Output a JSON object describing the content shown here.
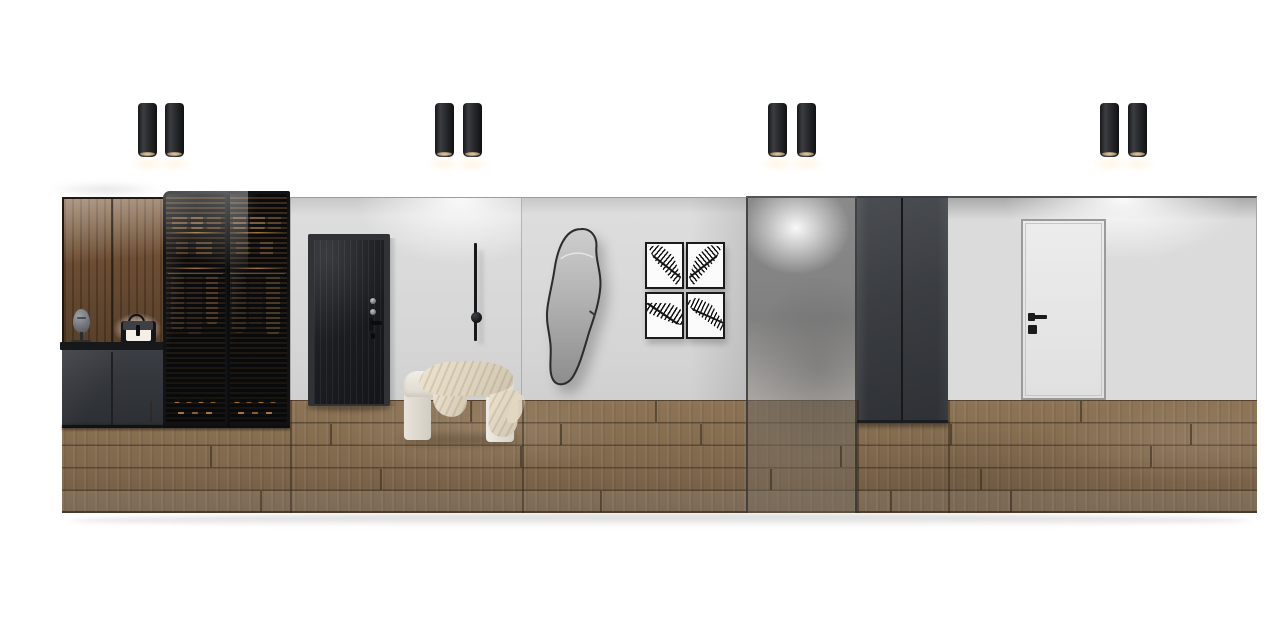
{
  "scene": {
    "title": "hallway-entry-interior-elevation-render",
    "background": "#ffffff",
    "objects": [
      "black cylinder ceiling spotlights (4 pairs)",
      "walnut display niche with mask sculpture and lit handbag shelf",
      "dark grey shoe cabinet with countertop",
      "slatted smoked-glass wardrobe with folded clothes, hanging garments and shoe rows",
      "black ribbed entry door with metal hardware",
      "thin black linear wall sconce with sphere",
      "cream upholstered waterfall bench with draped throw blanket",
      "organic-shaped wall mirror with thin black frame",
      "gallery of four black-framed palm leaf prints",
      "smoked glass partition panel",
      "charcoal double wall panels",
      "white flush interior door with black handle",
      "oak plank flooring strip with soft shadow below"
    ]
  },
  "palette": {
    "wall_light": "#dcdcdc",
    "wood_panel": "#6e4f36",
    "cabinet_dark": "#34373c",
    "wardrobe_black": "#17181b",
    "interior_warm": "#3a2b1e",
    "glow_warm": "#d89a52",
    "entry_door": "#1b1d20",
    "floor_wood": "#81694d",
    "bench_cream": "#e9e5dd",
    "blanket_cream": "#dcd2bd",
    "mirror_glass": "#a6a6a6",
    "glass_tint": "#8a8a8a",
    "panel_charcoal": "#3a3d41",
    "white_door": "#e4e4e4",
    "hardware_black": "#1b1b1b",
    "ceiling_line": "#4e4f52"
  },
  "lights": {
    "style": "black-cylinder-spot",
    "y": 103,
    "width": 19,
    "height": 54,
    "pairs": [
      [
        138,
        165
      ],
      [
        435,
        463
      ],
      [
        768,
        797
      ],
      [
        1100,
        1128
      ]
    ]
  },
  "gallery": {
    "theme": "palm-leaf-prints",
    "count": 4,
    "w": 39,
    "h": 47,
    "frames": [
      {
        "x": 645,
        "y": 242,
        "v": 1
      },
      {
        "x": 686,
        "y": 242,
        "v": 2
      },
      {
        "x": 645,
        "y": 292,
        "v": 3
      },
      {
        "x": 686,
        "y": 292,
        "v": 4
      }
    ]
  },
  "wardrobe": {
    "shelf_colors": [
      "#7b5a39",
      "#8a6843",
      "#684b2f"
    ],
    "accessory_colors": [
      "#5d4227",
      "#6e4e2e"
    ],
    "shoe_colors": [
      "#bd8446",
      "#9a6a38"
    ],
    "doors": [
      {
        "shelf_items": [
          {
            "x": 6,
            "w": 15
          },
          {
            "x": 25,
            "w": 12
          },
          {
            "x": 41,
            "w": 14
          }
        ],
        "accessories": [
          {
            "x": 10,
            "w": 12
          },
          {
            "x": 30,
            "w": 16
          }
        ],
        "garments": [
          {
            "x": 5,
            "w": 13,
            "h": 56,
            "c": "#4a3626"
          },
          {
            "x": 21,
            "w": 15,
            "h": 60,
            "c": "#3a2c20"
          },
          {
            "x": 40,
            "w": 12,
            "h": 50,
            "c": "#5c422c"
          }
        ],
        "shoes": [
          [
            8,
            0
          ],
          [
            20,
            0
          ],
          [
            32,
            0
          ],
          [
            44,
            0
          ],
          [
            12,
            1
          ],
          [
            26,
            1
          ],
          [
            40,
            1
          ]
        ]
      },
      {
        "shelf_items": [
          {
            "x": 5,
            "w": 13
          },
          {
            "x": 22,
            "w": 15
          },
          {
            "x": 40,
            "w": 13
          }
        ],
        "accessories": [
          {
            "x": 8,
            "w": 14
          },
          {
            "x": 32,
            "w": 13
          }
        ],
        "garments": [
          {
            "x": 4,
            "w": 14,
            "h": 58,
            "c": "#463324"
          },
          {
            "x": 21,
            "w": 13,
            "h": 52,
            "c": "#33271d"
          },
          {
            "x": 38,
            "w": 14,
            "h": 60,
            "c": "#54402b"
          }
        ],
        "shoes": [
          [
            6,
            0
          ],
          [
            18,
            0
          ],
          [
            30,
            0
          ],
          [
            42,
            0
          ],
          [
            10,
            1
          ],
          [
            24,
            1
          ],
          [
            38,
            1
          ]
        ]
      }
    ]
  },
  "floor": {
    "x": 62,
    "y": 400,
    "w": 1195,
    "h": 113,
    "row_height": 22.5,
    "seams": [
      [
        150,
        0
      ],
      [
        470,
        0
      ],
      [
        655,
        0
      ],
      [
        1080,
        0
      ],
      [
        330,
        1
      ],
      [
        560,
        1
      ],
      [
        700,
        1
      ],
      [
        950,
        1
      ],
      [
        1190,
        1
      ],
      [
        210,
        2
      ],
      [
        520,
        2
      ],
      [
        840,
        2
      ],
      [
        1150,
        2
      ],
      [
        380,
        3
      ],
      [
        770,
        3
      ],
      [
        980,
        3
      ],
      [
        260,
        4
      ],
      [
        600,
        4
      ],
      [
        890,
        4
      ],
      [
        1010,
        4
      ]
    ],
    "section_lines": [
      290,
      522,
      857,
      948
    ]
  }
}
